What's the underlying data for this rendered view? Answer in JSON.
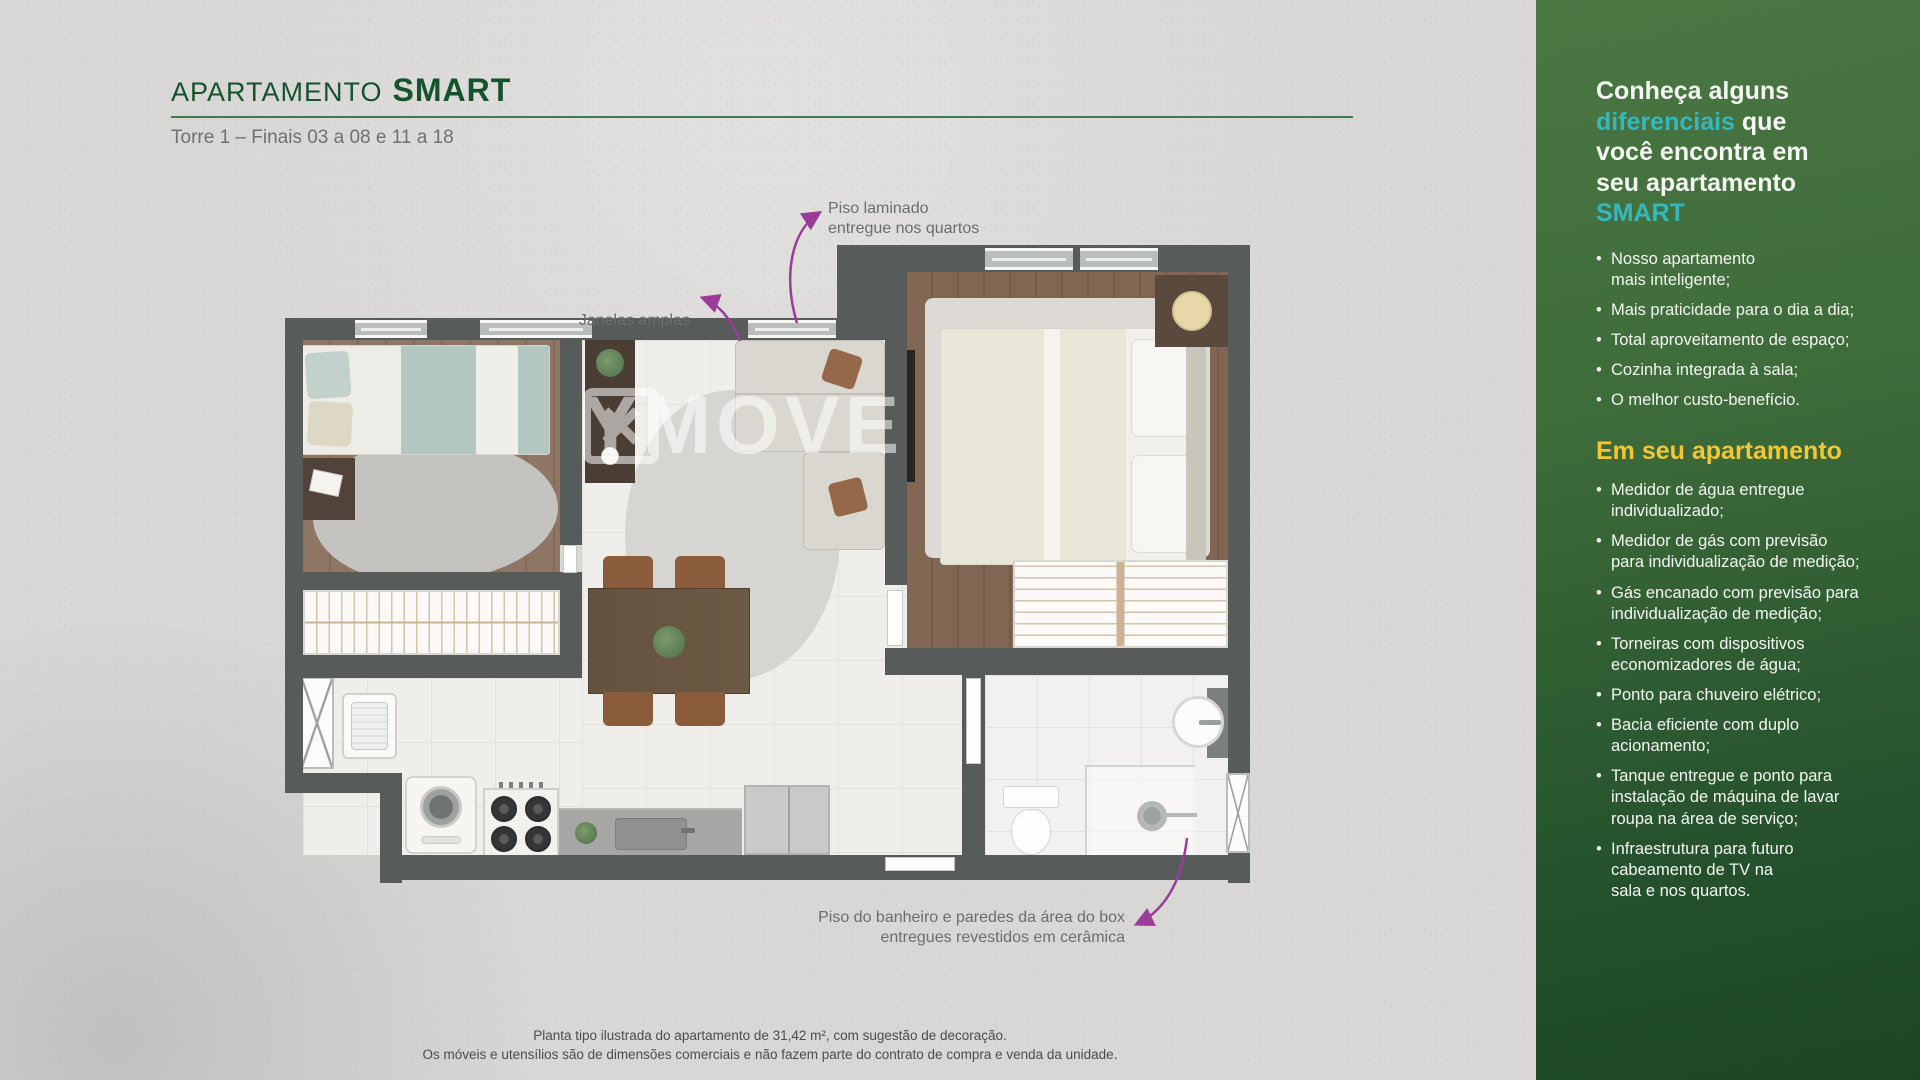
{
  "header": {
    "title_prefix": "APARTAMENTO",
    "title_name": "SMART",
    "subtitle": "Torre 1 – Finais 03 a 08 e 11 a 18"
  },
  "annotations": {
    "windows_label": "Janelas amplas",
    "laminate_label": "Piso laminado\nentregue nos quartos",
    "bath_label": "Piso do banheiro e paredes da área do box\nentregues revestidos em cerâmica"
  },
  "watermark": {
    "text": "YMOVE"
  },
  "sidebar": {
    "heading": {
      "part1": "Conheça alguns\n",
      "highlight1": "diferenciais",
      "part2": " que\nvocê encontra em\nseu apartamento\n",
      "highlight2": "SMART"
    },
    "intro_bullets": [
      "Nosso apartamento\nmais inteligente;",
      "Mais praticidade para o dia a dia;",
      "Total aproveitamento de espaço;",
      "Cozinha integrada à sala;",
      "O melhor custo-benefício."
    ],
    "section_title": "Em seu apartamento",
    "feature_bullets": [
      "Medidor de água entregue\nindividualizado;",
      "Medidor de gás com previsão\npara individualização de medição;",
      "Gás encanado com previsão para\nindividualização de medição;",
      "Torneiras com dispositivos\neconomizadores de água;",
      "Ponto para chuveiro elétrico;",
      "Bacia eficiente com duplo\nacionamento;",
      "Tanque entregue e ponto para\ninstalação de máquina de lavar\nroupa na área de serviço;",
      "Infraestrutura para futuro\ncabeamento de TV na\nsala e nos quartos."
    ]
  },
  "footer": {
    "line1": "Planta tipo ilustrada do apartamento de 31,42 m², com sugestão de decoração.",
    "line2": "Os móveis e utensílios são de dimensões comerciais e não fazem parte do contrato de compra e venda da unidade."
  },
  "colors": {
    "accent_green": "#14532d",
    "rule_green": "#3e7d4b",
    "teal": "#35b7bd",
    "yellow": "#f2c733",
    "purple": "#9b3c98",
    "wall": "#575c5a",
    "bg": "#d8d7d5"
  }
}
